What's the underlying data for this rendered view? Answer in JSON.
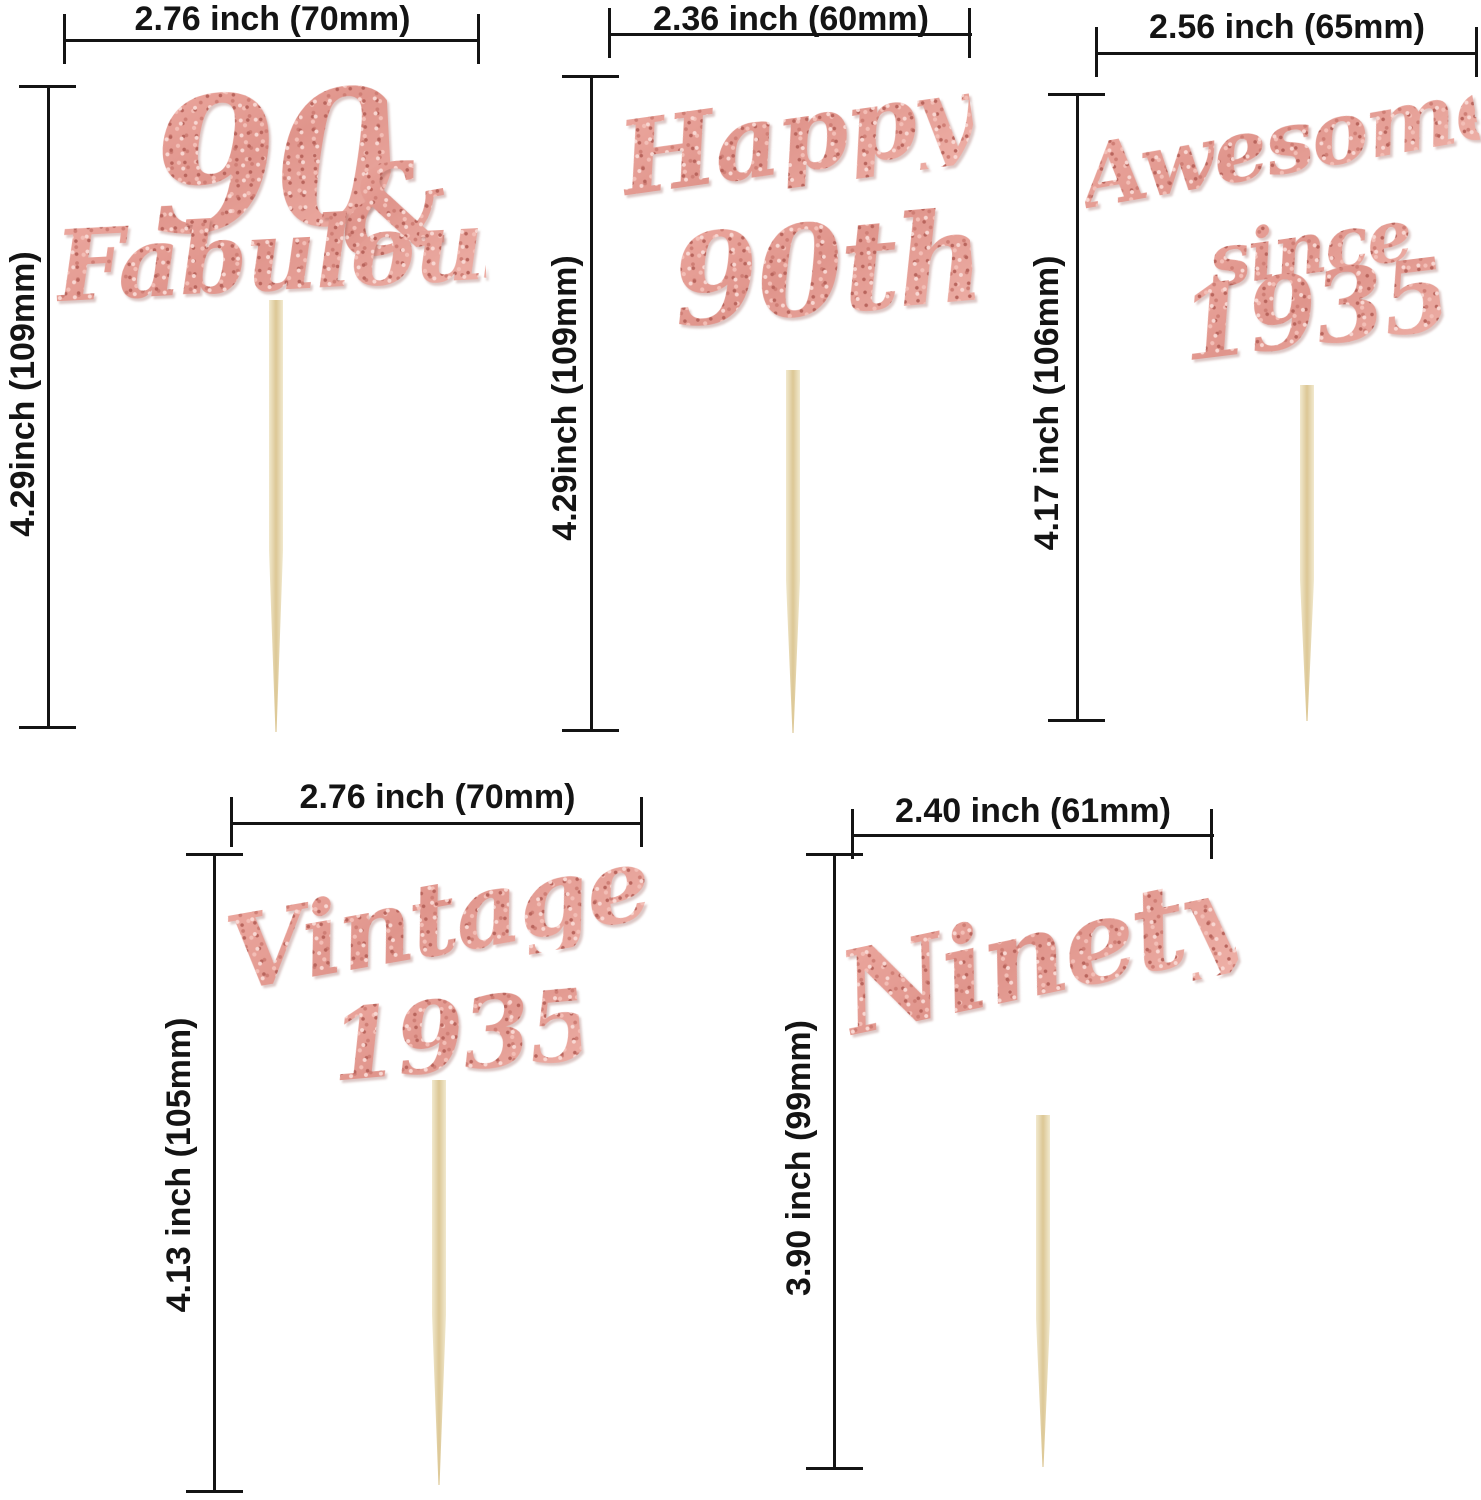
{
  "page": {
    "width": 1481,
    "height": 1500,
    "background": "#ffffff"
  },
  "colors": {
    "dimension": "#141414",
    "glitter_base": "#e0958c",
    "glitter_light": "#f8d7d2",
    "glitter_dark": "#b9655d",
    "stick_light": "#f1e9ce",
    "stick_dark": "#dcc795"
  },
  "toppers": [
    {
      "name": "90 & Fabulous cupcake topper",
      "width_label": "2.76 inch (70mm)",
      "height_label": "4.29inch (109mm)",
      "parts": [
        "90",
        "&",
        "Fabulous"
      ]
    },
    {
      "name": "Happy 90th cupcake topper",
      "width_label": "2.36 inch (60mm)",
      "height_label": "4.29inch (109mm)",
      "parts": [
        "Happy",
        "90th"
      ]
    },
    {
      "name": "Awesome since 1935 cupcake topper",
      "width_label": "2.56 inch (65mm)",
      "height_label": "4.17 inch (106mm)",
      "parts": [
        "Awesome",
        "since",
        "1935"
      ]
    },
    {
      "name": "Vintage 1935 cupcake topper",
      "width_label": "2.76 inch (70mm)",
      "height_label": "4.13 inch (105mm)",
      "parts": [
        "Vintage",
        "1935"
      ]
    },
    {
      "name": "Ninety cupcake topper",
      "width_label": "2.40 inch (61mm)",
      "height_label": "3.90 inch (99mm)",
      "parts": [
        "Ninety"
      ]
    }
  ]
}
